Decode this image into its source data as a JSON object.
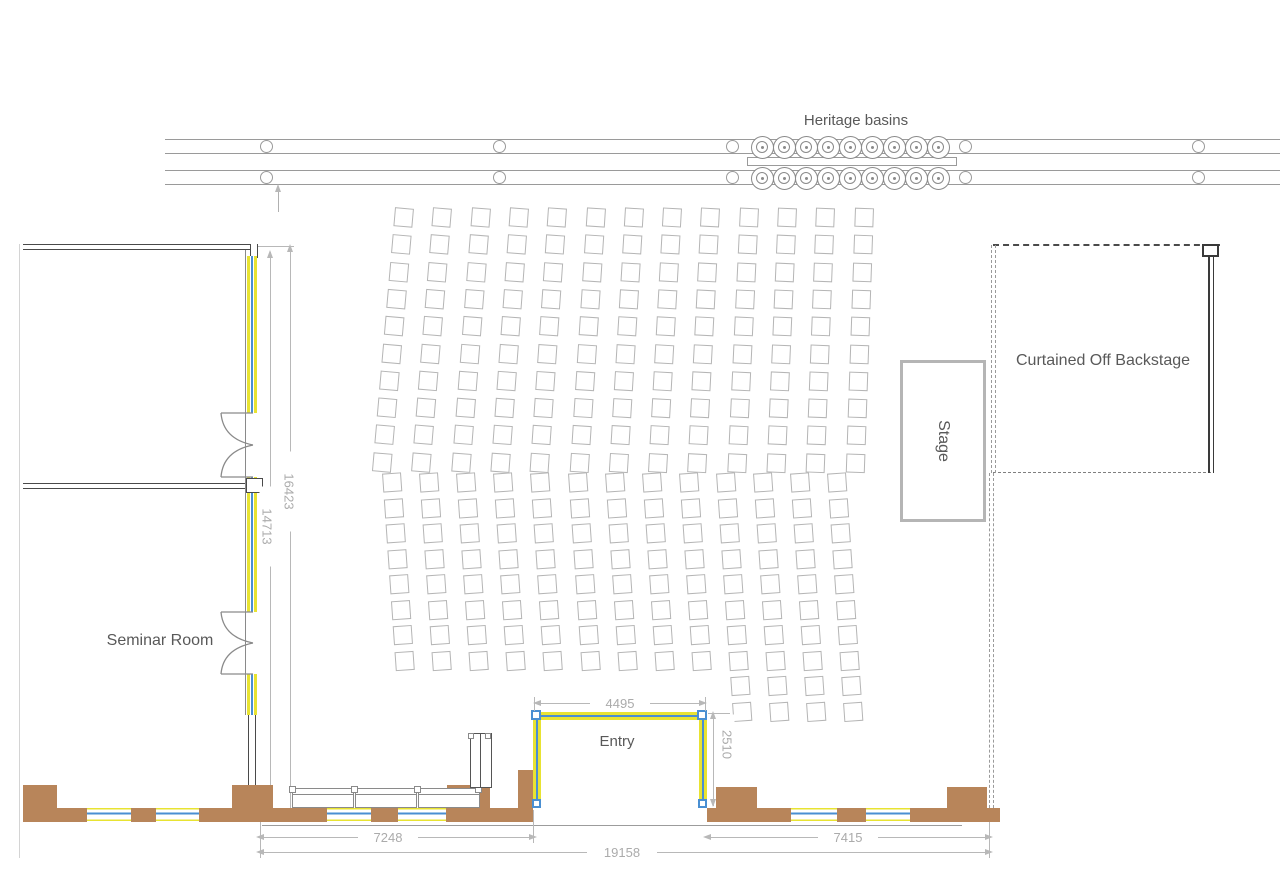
{
  "labels": {
    "heritage_basins": "Heritage basins",
    "seminar_room": "Seminar Room",
    "entry": "Entry",
    "stage": "Stage",
    "backstage": "Curtained Off Backstage"
  },
  "dimensions": {
    "entry_width": "4495",
    "entry_depth": "2510",
    "hall_height_inner": "14713",
    "hall_height_outer": "16423",
    "left_frontage": "7248",
    "right_frontage": "7415",
    "total_frontage": "19158"
  },
  "colors": {
    "brown": "#b8855a",
    "yellow": "#e8e332",
    "blue": "#4a8fd2",
    "walldark": "#4a4a4a",
    "line": "#9a9a9a",
    "dim": "#b8b8b8",
    "dimtext": "#ababab",
    "labeltext": "#595959",
    "seat": "#b5b5b5",
    "stageborder": "#b5b5b5"
  },
  "heritage": {
    "basins_per_row": 9,
    "rows": 2,
    "start_x": 762,
    "spacing": 22,
    "row_center_y": [
      147,
      178
    ],
    "post_xs": [
      266,
      499,
      732,
      965,
      1198
    ],
    "post_center_y": [
      146.5,
      177.5
    ]
  },
  "seating": {
    "upper_block": {
      "columns": 13,
      "rows": 10,
      "origin_x": 395,
      "origin_y": 208,
      "col_spacing": 38.3,
      "row_spacing": 27.3,
      "seat_size": 19,
      "tilt_start": 5,
      "tilt_step": -0.25
    },
    "lower_block": {
      "columns": 13,
      "rows": 8,
      "extended_columns": 4,
      "extended_rows": 10,
      "origin_x": 382,
      "origin_y": 473,
      "col_spacing": 37.1,
      "row_spacing": 25.5,
      "seat_size": 19,
      "tilt_start": -4,
      "tilt_step": 0
    }
  }
}
